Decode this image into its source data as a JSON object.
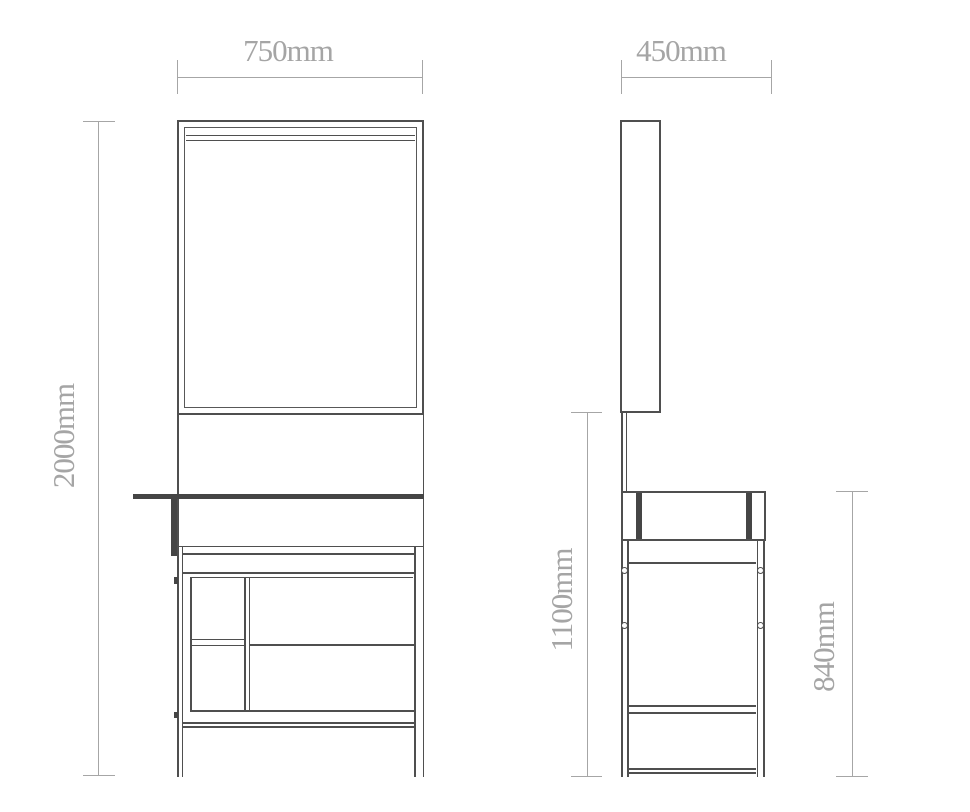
{
  "drawing": {
    "kind": "furniture dimension drawing",
    "views": [
      "front elevation",
      "side elevation"
    ]
  },
  "dimensions": {
    "front_width": "750mm",
    "front_total_height": "2000mm",
    "side_depth": "450mm",
    "side_mirror_bottom_height": "1100mm",
    "side_table_height": "840mm"
  },
  "colors": {
    "background": "#ffffff",
    "drawing_line": "#4f4f4f",
    "drawing_thick": "#454545",
    "dimension_line": "#a6a6a6",
    "dimension_text": "#a5a5a5"
  }
}
